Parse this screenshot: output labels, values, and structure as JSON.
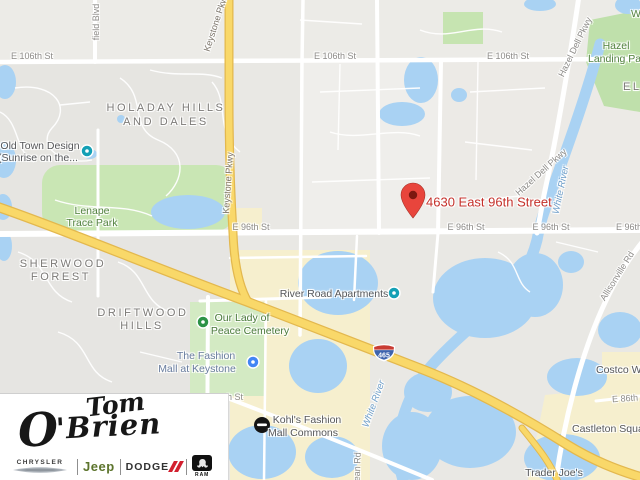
{
  "map": {
    "marker_address": "4630 East 96th Street",
    "shield": "465",
    "roads": {
      "e106th": "E 106th St",
      "e96th": "E 96th St",
      "e86th": "E 86th St",
      "keystone": "Keystone Pkwy",
      "hazel_dell": "Hazel Dell Pkwy",
      "allisonville": "Allisonville Rd",
      "field_blvd": "field Blvd",
      "dean_rd": "Dean Rd",
      "partial_st": "h St"
    },
    "neighborhoods": {
      "holaday_line1": "HOLADAY HILLS",
      "holaday_line2": "AND DALES",
      "sherwood_line1": "SHERWOOD",
      "sherwood_line2": "FOREST",
      "driftwood_line1": "DRIFTWOOD",
      "driftwood_line2": "HILLS",
      "partial_east": "EL"
    },
    "parks": {
      "lenape_line1": "Lenape",
      "lenape_line2": "Trace Park",
      "hazel_landing_line1": "Hazel",
      "hazel_landing_line2": "Landing Park",
      "partial_w": "W"
    },
    "water": {
      "white_river": "White River"
    },
    "pois": {
      "old_town_line1": "Old Town Design",
      "old_town_line2": "(Sunrise on the...",
      "river_road_apartments": "River Road Apartments",
      "cemetery_line1": "Our Lady of",
      "cemetery_line2": "Peace Cemetery",
      "fashion_mall_line1": "The Fashion",
      "fashion_mall_line2": "Mall at Keystone",
      "kohls_line1": "Kohl's Fashion",
      "kohls_line2": "Mall Commons",
      "castleton": "Castleton Square",
      "trader_joes": "Trader Joe's",
      "costco": "Costco Wholesale"
    },
    "colors": {
      "water": "#a9d2f3",
      "park_green": "#c9e6b4",
      "highway_yellow": "#f9d869",
      "commercial_beige": "#f6efce",
      "marker_red": "#e8453c",
      "marker_text_red": "#c5312b"
    }
  },
  "dealer_logo": {
    "name_first": "Tom",
    "name_last": "O'Brien",
    "brand_chrysler": "CHRYSLER",
    "brand_jeep": "Jeep",
    "brand_dodge": "DODGE",
    "brand_ram": "RAM"
  }
}
